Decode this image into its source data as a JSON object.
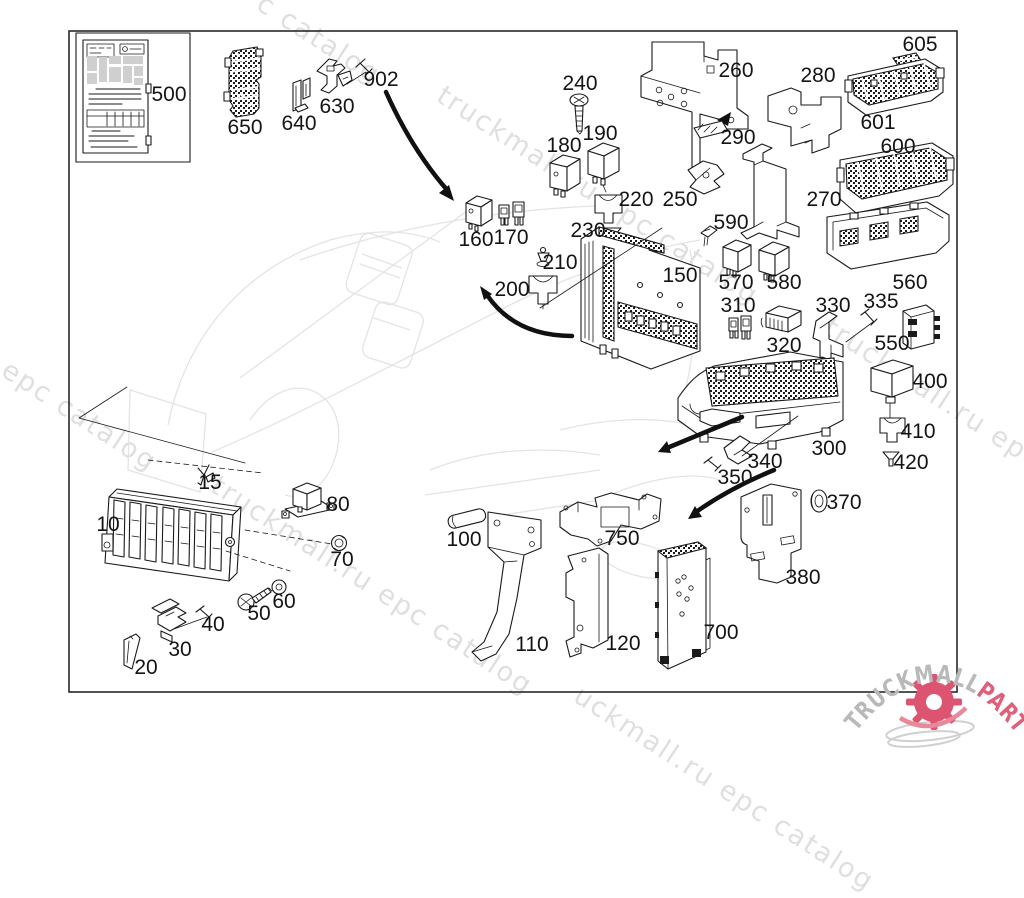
{
  "diagram": {
    "kind": "exploded-parts-diagram",
    "line_color": "#1a1a1a",
    "background": "#ffffff"
  },
  "watermark": {
    "text": "truckmall.ru epc catalog",
    "color": "#d8d8d8",
    "instances": [
      {
        "text": "c catalog",
        "x": 268,
        "y": -12
      },
      {
        "text": "truckmall.ru epc catalog",
        "x": 448,
        "y": 80
      },
      {
        "text": "ll.ru epc catalog",
        "x": -48,
        "y": 315
      },
      {
        "text": "truckmall.ru epc catalog",
        "x": 222,
        "y": 470
      },
      {
        "text": "truckmall.ru epc catalog",
        "x": 835,
        "y": 312
      },
      {
        "text": "uckmall.ru epc catalog",
        "x": 585,
        "y": 680
      }
    ]
  },
  "logo": {
    "brand_gray": "TRUCKMALL",
    "brand_pink": "PARTS",
    "gray": "#b9b9b9",
    "pink": "#e0607a",
    "gear_color": "#dd5471",
    "swoosh_color": "#e8899b",
    "trail_color": "#d0d0d0"
  },
  "callouts": [
    {
      "n": "500",
      "x": 169,
      "y": 95,
      "part": "data-label-sticker"
    },
    {
      "n": "650",
      "x": 245,
      "y": 128,
      "part": "fuse-module-stack"
    },
    {
      "n": "640",
      "x": 299,
      "y": 124,
      "part": "retaining-clip"
    },
    {
      "n": "630",
      "x": 337,
      "y": 107,
      "part": "mounting-clip"
    },
    {
      "n": "902",
      "x": 381,
      "y": 80,
      "part": "screw"
    },
    {
      "n": "240",
      "x": 580,
      "y": 84,
      "part": "screw"
    },
    {
      "n": "180",
      "x": 564,
      "y": 146,
      "part": "relay"
    },
    {
      "n": "190",
      "x": 600,
      "y": 134,
      "part": "relay"
    },
    {
      "n": "220",
      "x": 636,
      "y": 200,
      "part": "connector-sleeve"
    },
    {
      "n": "230",
      "x": 588,
      "y": 231,
      "part": "grommet-cone"
    },
    {
      "n": "250",
      "x": 680,
      "y": 200,
      "part": "bracket"
    },
    {
      "n": "270",
      "x": 824,
      "y": 200,
      "part": "mounting-bracket"
    },
    {
      "n": "260",
      "x": 736,
      "y": 71,
      "part": "mounting-bracket"
    },
    {
      "n": "290",
      "x": 738,
      "y": 138,
      "part": "cover-strip"
    },
    {
      "n": "280",
      "x": 818,
      "y": 76,
      "part": "bracket-plate"
    },
    {
      "n": "605",
      "x": 920,
      "y": 45,
      "part": "cover-strip"
    },
    {
      "n": "601",
      "x": 878,
      "y": 123,
      "part": "fuse-strip-module"
    },
    {
      "n": "600",
      "x": 898,
      "y": 147,
      "part": "fuse-strip-module"
    },
    {
      "n": "160",
      "x": 476,
      "y": 240,
      "part": "relay"
    },
    {
      "n": "170",
      "x": 511,
      "y": 238,
      "part": "fuse-links"
    },
    {
      "n": "210",
      "x": 560,
      "y": 263,
      "part": "grommet-cone"
    },
    {
      "n": "200",
      "x": 512,
      "y": 290,
      "part": "connector-sleeve"
    },
    {
      "n": "150",
      "x": 680,
      "y": 276,
      "part": "fuse-box-upper"
    },
    {
      "n": "590",
      "x": 731,
      "y": 223,
      "part": "clip"
    },
    {
      "n": "570",
      "x": 736,
      "y": 283,
      "part": "relay"
    },
    {
      "n": "580",
      "x": 784,
      "y": 283,
      "part": "relay"
    },
    {
      "n": "560",
      "x": 910,
      "y": 283,
      "part": "fuse-box-tray"
    },
    {
      "n": "310",
      "x": 738,
      "y": 306,
      "part": "fuse-links"
    },
    {
      "n": "320",
      "x": 784,
      "y": 346,
      "part": "connector-housing"
    },
    {
      "n": "330",
      "x": 833,
      "y": 306,
      "part": "bracket"
    },
    {
      "n": "335",
      "x": 881,
      "y": 302,
      "part": "screw"
    },
    {
      "n": "550",
      "x": 892,
      "y": 344,
      "part": "connector"
    },
    {
      "n": "400",
      "x": 930,
      "y": 382,
      "part": "relay"
    },
    {
      "n": "410",
      "x": 918,
      "y": 432,
      "part": "connector-sleeve"
    },
    {
      "n": "420",
      "x": 911,
      "y": 463,
      "part": "grommet-cone"
    },
    {
      "n": "300",
      "x": 829,
      "y": 449,
      "part": "fuse-box-lower"
    },
    {
      "n": "340",
      "x": 765,
      "y": 462,
      "part": "bracket"
    },
    {
      "n": "350",
      "x": 735,
      "y": 478,
      "part": "screw"
    },
    {
      "n": "370",
      "x": 844,
      "y": 503,
      "part": "grommet"
    },
    {
      "n": "380",
      "x": 803,
      "y": 578,
      "part": "mounting-plate"
    },
    {
      "n": "10",
      "x": 108,
      "y": 525,
      "part": "relay-carrier"
    },
    {
      "n": "15",
      "x": 210,
      "y": 483,
      "part": "clip"
    },
    {
      "n": "80",
      "x": 338,
      "y": 505,
      "part": "relay-with-bracket"
    },
    {
      "n": "70",
      "x": 342,
      "y": 560,
      "part": "nut"
    },
    {
      "n": "60",
      "x": 284,
      "y": 602,
      "part": "washer"
    },
    {
      "n": "50",
      "x": 259,
      "y": 614,
      "part": "screw"
    },
    {
      "n": "40",
      "x": 213,
      "y": 625,
      "part": "rivet-pin"
    },
    {
      "n": "30",
      "x": 180,
      "y": 650,
      "part": "bracket"
    },
    {
      "n": "20",
      "x": 146,
      "y": 668,
      "part": "plate"
    },
    {
      "n": "100",
      "x": 464,
      "y": 540,
      "part": "pin"
    },
    {
      "n": "110",
      "x": 532,
      "y": 645,
      "part": "support-bracket"
    },
    {
      "n": "120",
      "x": 623,
      "y": 644,
      "part": "bracket"
    },
    {
      "n": "750",
      "x": 622,
      "y": 539,
      "part": "mounting-frame"
    },
    {
      "n": "700",
      "x": 721,
      "y": 633,
      "part": "mounting-panel"
    }
  ]
}
